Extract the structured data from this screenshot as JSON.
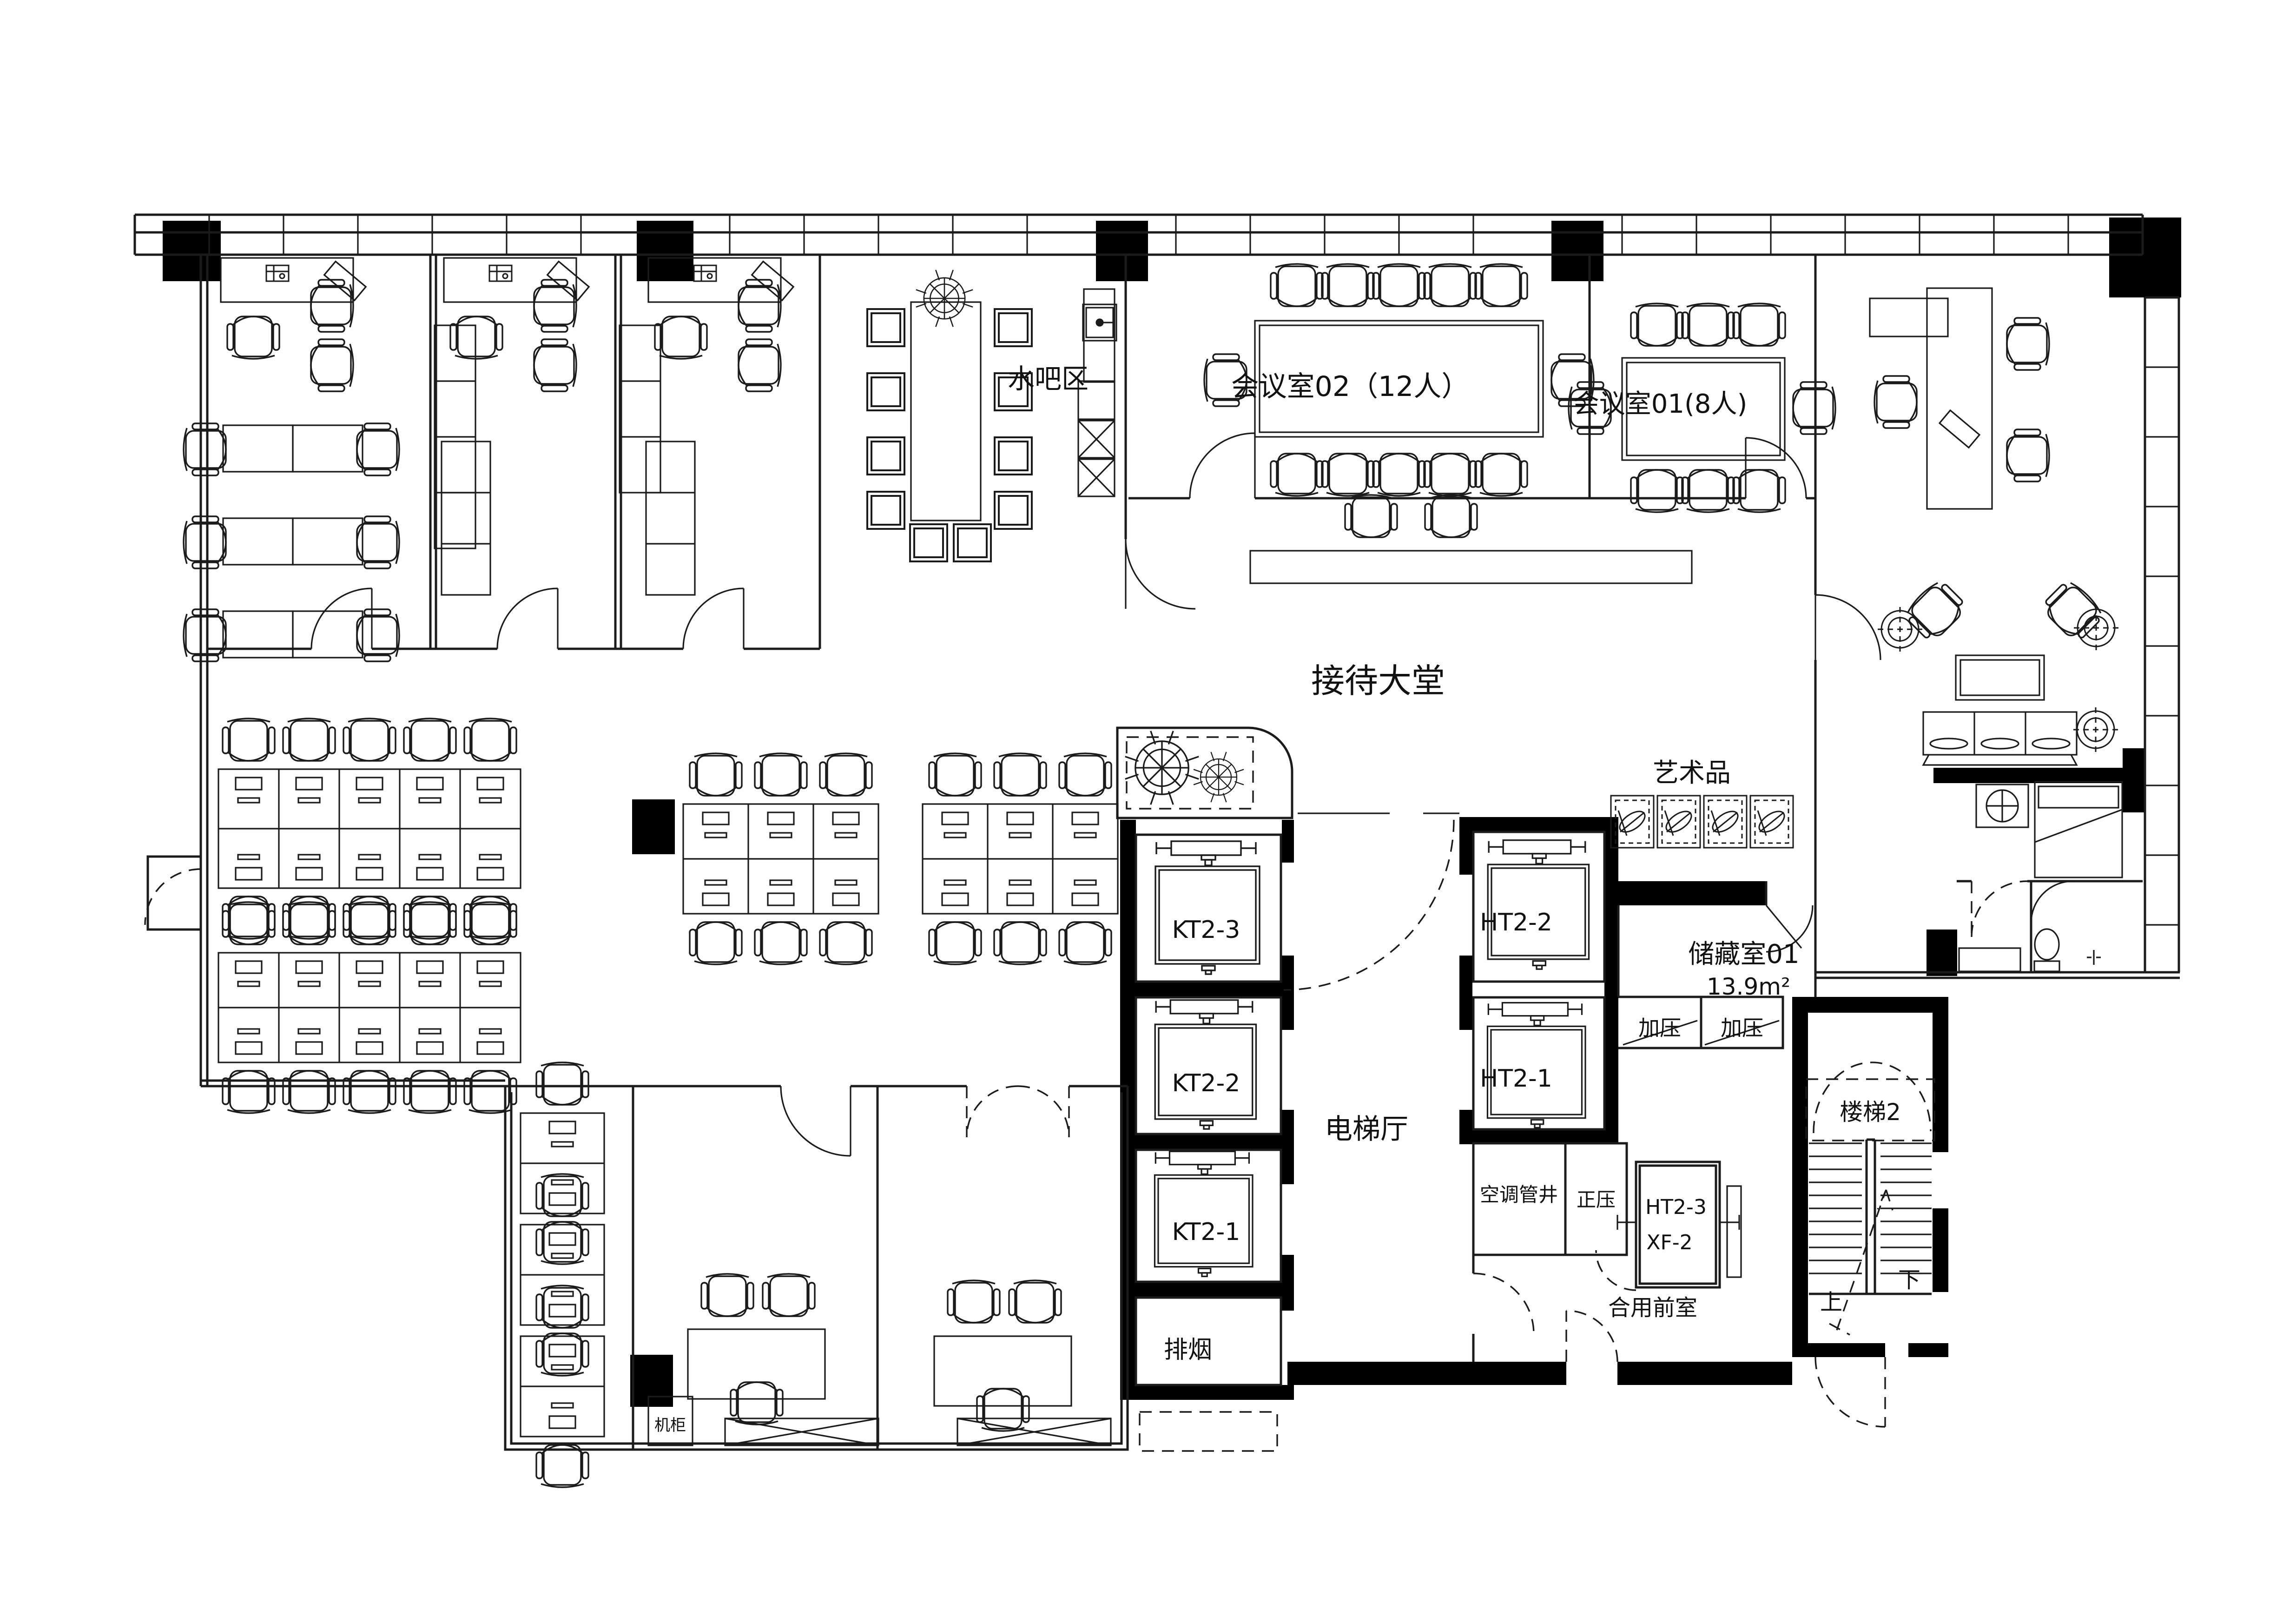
{
  "drawing": {
    "type": "architectural-floor-plan",
    "discipline": "office interior layout"
  },
  "colors": {
    "line": "#1b1b1b",
    "wall_fill": "#000000",
    "background": "#ffffff"
  },
  "labels": {
    "water_bar": "水吧区",
    "meeting_room_02": "会议室02（12人）",
    "meeting_room_01": "会议室01(8人)",
    "reception_lobby": "接待大堂",
    "artwork": "艺术品",
    "storage_room": "储藏室01",
    "storage_area": "13.9m²",
    "elevator_hall": "电梯厅",
    "kt2_3": "KT2-3",
    "kt2_2": "KT2-2",
    "kt2_1": "KT2-1",
    "ht2_2": "HT2-2",
    "ht2_1": "HT2-1",
    "ht2_3": "HT2-3",
    "xf_2": "XF-2",
    "smoke_exhaust": "排烟",
    "pressurized_1": "加压",
    "pressurized_2": "加压",
    "positive_pressure": "正压",
    "ac_duct_shaft": "空调管井",
    "stair_2": "楼梯2",
    "shared_front_room": "合用前室",
    "up": "上",
    "down": "下",
    "equipment_cabinet": "机柜"
  }
}
